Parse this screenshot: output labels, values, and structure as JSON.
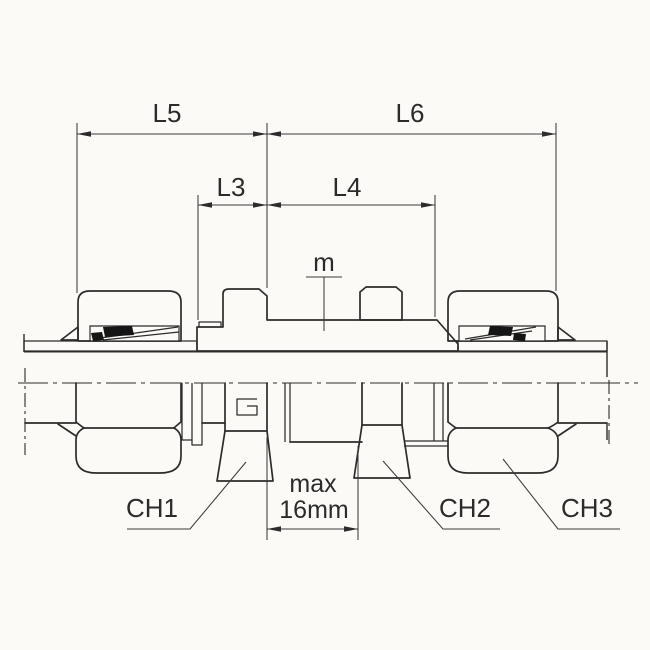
{
  "diagram": {
    "labels": {
      "l5": "L5",
      "l6": "L6",
      "l3": "L3",
      "l4": "L4",
      "m": "m",
      "ch1": "CH1",
      "ch2": "CH2",
      "ch3": "CH3"
    },
    "max_panel_thickness": {
      "line1": "max",
      "line2": "16mm"
    },
    "colors": {
      "line": "#2c2c2c",
      "dimension_line": "#3b3b3b",
      "background": "#fbfaf7",
      "seal": "#151515",
      "hatch": "#3a3a3a"
    }
  }
}
